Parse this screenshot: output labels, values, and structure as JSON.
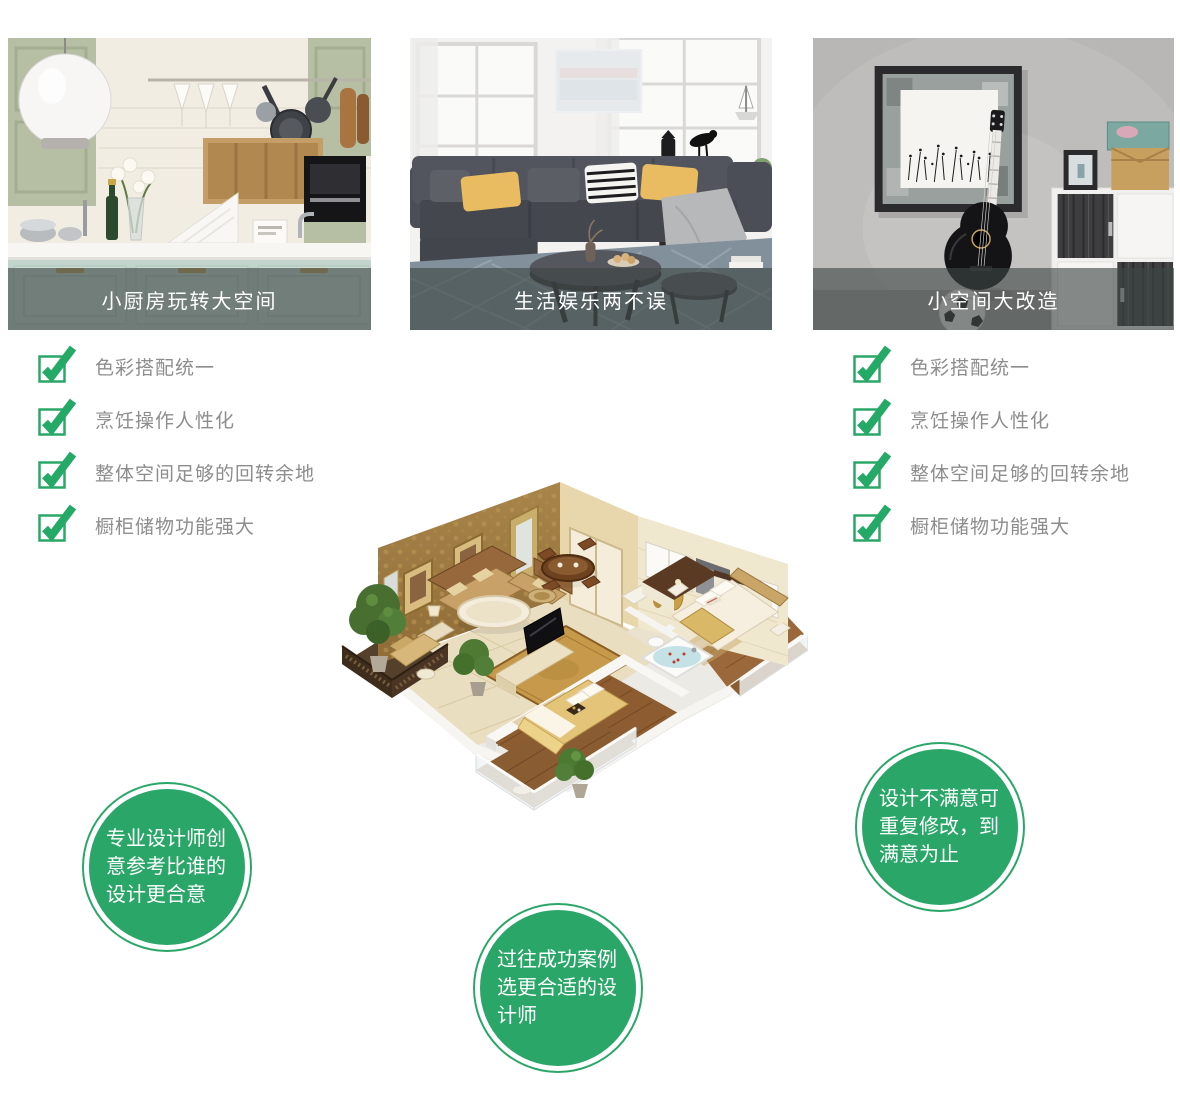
{
  "cards": [
    {
      "scene": "kitchen",
      "caption": "小厨房玩转大空间"
    },
    {
      "scene": "living-room",
      "caption": "生活娱乐两不误"
    },
    {
      "scene": "gray-room",
      "caption": "小空间大改造"
    }
  ],
  "checklist_left": {
    "items": [
      "色彩搭配统一",
      "烹饪操作人性化",
      "整体空间足够的回转余地",
      "橱柜储物功能强大"
    ]
  },
  "checklist_right": {
    "items": [
      "色彩搭配统一",
      "烹饪操作人性化",
      "整体空间足够的回转余地",
      "橱柜储物功能强大"
    ]
  },
  "badges": [
    {
      "text": "专业设计师创意参考比谁的设计更合意"
    },
    {
      "text": "过往成功案例选更合适的设计师"
    },
    {
      "text": "设计不满意可重复修改，到满意为止"
    }
  ],
  "colors": {
    "accent_green": "#2aa768",
    "checklist_text": "#8d8d8d",
    "caption_overlay": "rgba(62,70,68,0.62)",
    "caption_text": "#ffffff",
    "badge_text": "#ffffff",
    "page_background": "#ffffff"
  },
  "icons": {
    "checkmark": "check-icon"
  }
}
